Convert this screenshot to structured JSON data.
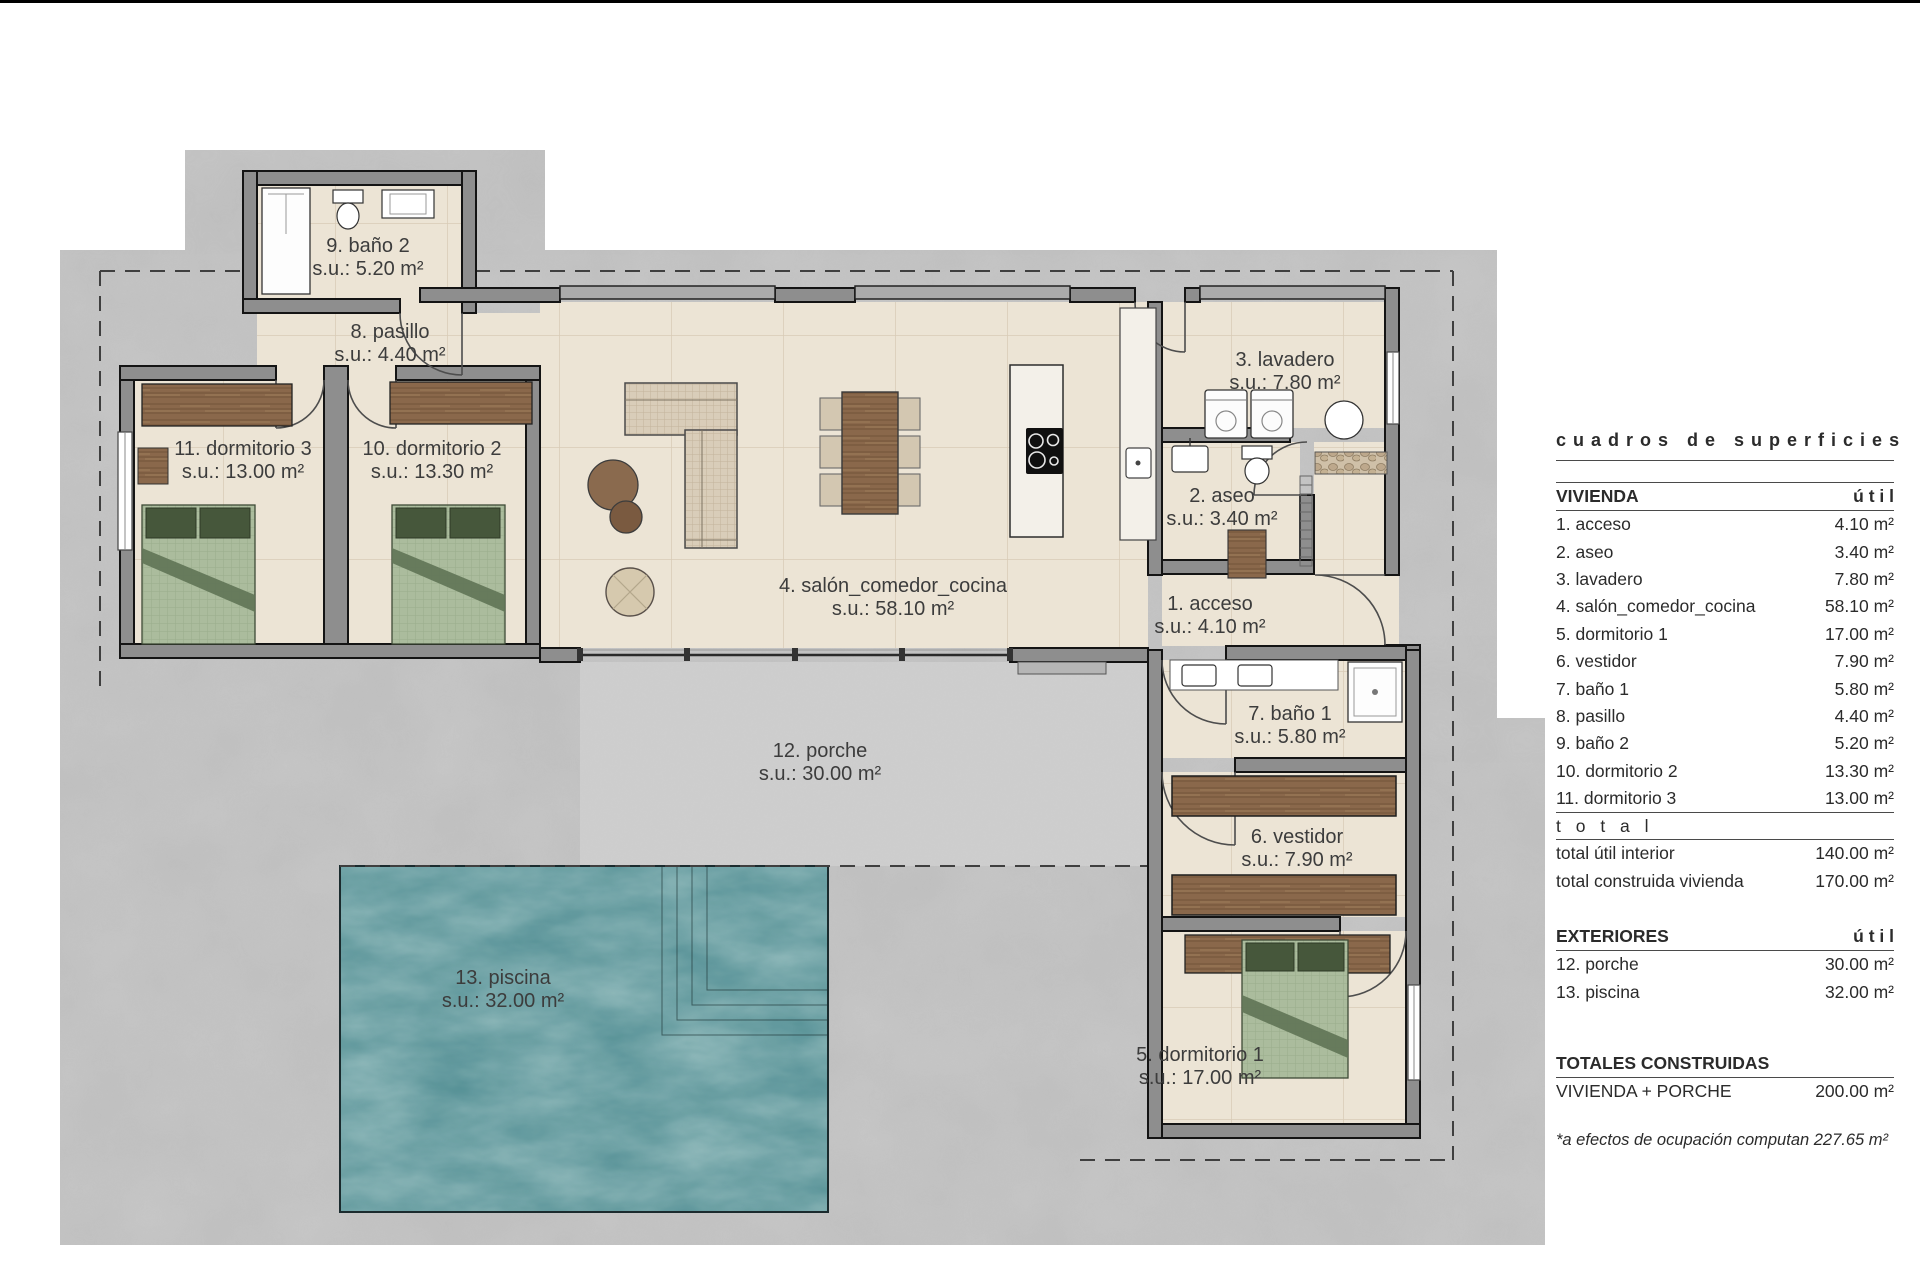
{
  "plan": {
    "rooms": [
      {
        "label": "9. baño 2",
        "area": "s.u.: 5.20 m²"
      },
      {
        "label": "8. pasillo",
        "area": "s.u.: 4.40 m²"
      },
      {
        "label": "11. dormitorio 3",
        "area": "s.u.: 13.00 m²"
      },
      {
        "label": "10. dormitorio 2",
        "area": "s.u.: 13.30 m²"
      },
      {
        "label": "4. salón_comedor_cocina",
        "area": "s.u.: 58.10 m²"
      },
      {
        "label": "3. lavadero",
        "area": "s.u.: 7.80 m²"
      },
      {
        "label": "2. aseo",
        "area": "s.u.: 3.40 m²"
      },
      {
        "label": "1. acceso",
        "area": "s.u.: 4.10 m²"
      },
      {
        "label": "7. baño 1",
        "area": "s.u.: 5.80 m²"
      },
      {
        "label": "6. vestidor",
        "area": "s.u.: 7.90 m²"
      },
      {
        "label": "12. porche",
        "area": "s.u.: 30.00 m²"
      },
      {
        "label": "13. piscina",
        "area": "s.u.: 32.00 m²"
      },
      {
        "label": "5. dormitorio 1",
        "area": "s.u.: 17.00 m²"
      }
    ]
  },
  "table": {
    "title": "cuadros de superficies",
    "vivienda": {
      "header": "VIVIENDA",
      "col": "ú t i l",
      "rows": [
        {
          "label": "1. acceso",
          "value": "4.10 m²"
        },
        {
          "label": "2. aseo",
          "value": "3.40 m²"
        },
        {
          "label": "3. lavadero",
          "value": "7.80 m²"
        },
        {
          "label": "4. salón_comedor_cocina",
          "value": "58.10 m²"
        },
        {
          "label": "5. dormitorio 1",
          "value": "17.00 m²"
        },
        {
          "label": "6. vestidor",
          "value": "7.90 m²"
        },
        {
          "label": "7. baño 1",
          "value": "5.80 m²"
        },
        {
          "label": "8. pasillo",
          "value": "4.40 m²"
        },
        {
          "label": "9. baño 2",
          "value": "5.20 m²"
        },
        {
          "label": "10. dormitorio 2",
          "value": "13.30 m²"
        },
        {
          "label": "11. dormitorio 3",
          "value": "13.00 m²"
        }
      ],
      "total_label": "t o t a l",
      "totals": [
        {
          "label": "total útil interior",
          "value": "140.00 m²"
        },
        {
          "label": "total construida vivienda",
          "value": "170.00 m²"
        }
      ]
    },
    "exteriores": {
      "header": "EXTERIORES",
      "col": "ú t i l",
      "rows": [
        {
          "label": "12. porche",
          "value": "30.00 m²"
        },
        {
          "label": "13. piscina",
          "value": "32.00 m²"
        }
      ]
    },
    "totales": {
      "header": "TOTALES CONSTRUIDAS",
      "rows": [
        {
          "label": "VIVIENDA + PORCHE",
          "value": "200.00 m²"
        }
      ]
    },
    "footnote": "*a efectos de ocupación computan 227.65 m²"
  },
  "colors": {
    "terrain": "#c7c7c7",
    "porch": "#cdcdcd",
    "floor_tile": "#ece4d5",
    "wall": "#8e8e8e",
    "wall_outline": "#141414",
    "wood": "#8a684b",
    "bed_green": "#abbc9d",
    "pillow_green": "#46573b",
    "pool_teal": "#4f8c92",
    "text": "#3c3c3c"
  }
}
